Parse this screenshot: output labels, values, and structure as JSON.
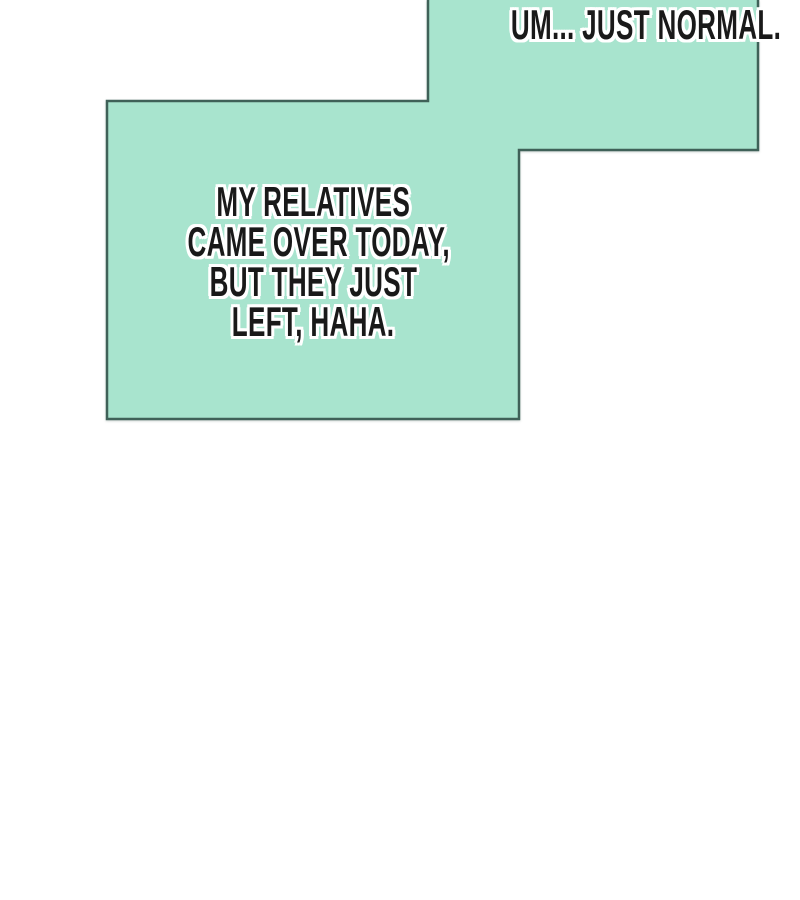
{
  "page": {
    "background": "#ffffff"
  },
  "colors": {
    "bubble_fill": "#a8e4ce",
    "bubble_border": "#3f6158",
    "text_color": "#191919",
    "text_outline": "#ffffff"
  },
  "bubbles": {
    "right": {
      "text": "UM... JUST NORMAL."
    },
    "left": {
      "lines": [
        "MY RELATIVES",
        "CAME OVER TODAY,",
        "BUT THEY JUST",
        "LEFT, HAHA."
      ]
    }
  }
}
